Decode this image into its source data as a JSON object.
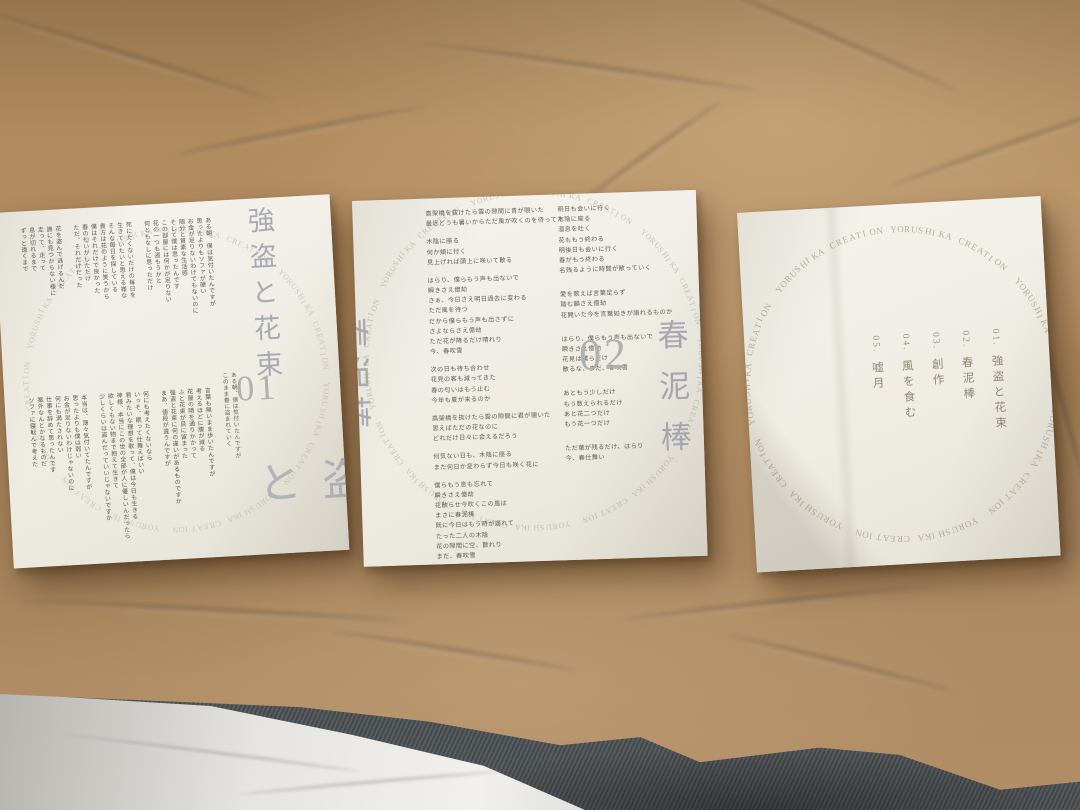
{
  "ring_text": "YORUSHIKA CREATION",
  "colors": {
    "kraft_paper": "#b28e66",
    "card_paper": "#f0ede5",
    "title_gray": "#a7abb3",
    "lyric_ink": "#5b584f",
    "ring_gray": "#b3ac97",
    "fabric_gray": "#4f5456",
    "tissue_white": "#eceae6"
  },
  "cards": {
    "left": {
      "title": "強盗と花束",
      "number": "01",
      "title_repeat": "強盗と",
      "number_caption": [
        [
          "ある朝、僕は気付いたんですが",
          "このまま春に盗まれていく"
        ]
      ],
      "lyrics_top": [
        [
          "ある朝、僕は気付いたんですが",
          "思ったよりもソファが硬い",
          "お金が足りないわけでもないのに",
          "随分と質素な生活感",
          "そして僕は思ったんです",
          "この部屋には何かが足りない",
          "花の一つも盗もうかと",
          "何ともなしに思っただけ"
        ],
        [
          "死にたくないだけの毎日を",
          "生きていたいと思える様な",
          "そんな毎日を探している",
          "貴方は花のように笑うから",
          "僕はそれだけで良かった",
          "春の匂いがしただけ",
          "ただ、それだけだった"
        ],
        [
          "花を盗んで逃げるんだ",
          "誰にも見つからない様に",
          "走って、走って",
          "息が切れるまで",
          "ずっと遠くまで"
        ]
      ],
      "lyrics_bottom": [
        [
          "言葉も無いまま歩いたんですが",
          "考えるほどに腹が減る",
          "花屋の隣を通りかかって",
          "ふと花束が目に留まった",
          "強盗と花束に何の違いがあるものですか",
          "まあ、値段が違うんですが"
        ],
        [
          "何にも考えたくないなら",
          "いっそ、眠って仕舞えばいい",
          "君みたいな理想を歌って、僕は今日も生きる",
          "神様、本当にこの世の全部が人に優しいんだったら",
          "欲しくもない物まで抱えて生きて",
          "少しくらいは盗んだっていいじゃないですか"
        ],
        [
          "本当は、薄々気付いてたんですが",
          "思ったよりも僕は弱い",
          "お金が足りないわけじゃないのに",
          "何にも満たされない",
          "仕事を辞めて思ったんです",
          "案外なんとかなるものだ",
          "ソファに寝転んで考えた"
        ]
      ]
    },
    "middle": {
      "title": "春泥棒",
      "side_title": "春泥棒",
      "number": "02",
      "lyrics_left": [
        [
          "高架橋を抜けたら雲の隙間に青が覗いた",
          "最近どうも暑いからただ風が吹くのを待ってた"
        ],
        [
          "木陰に座る",
          "何か頬に付く",
          "見上げれば頭上に咲いて散る"
        ],
        [
          "はらり、僕らもう声も出ないで",
          "瞬きさえ億劫",
          "さぁ、今日さえ明日過去に変わる",
          "ただ風を待つ",
          "だから僕らもう声も出さずに",
          "さよならさえ億劫",
          "ただ花が降るだけ晴れり",
          "今、春吹雪"
        ],
        [
          "次の日も待ち合わせ",
          "花見の客も減ってきた",
          "春の匂いはもう止む",
          "今年も夏が来るのか"
        ],
        [
          "高架橋を抜けたら雲の隙間に君が覗いた",
          "思えばただの花なのに",
          "どれだけ日々に会えるだろう"
        ],
        [
          "何気ない日も、木陰に座る",
          "また何日か変わらず今日も咲く花に"
        ],
        [
          "僕らもう息も忘れて",
          "瞬きさえ億劫",
          "花散らせ今吹くこの風は",
          "まさに春泥棒",
          "既に今日はもう時が遅れて",
          "たった二人の木陰",
          "花の隙間に空、散れり",
          "まだ、春吹雪"
        ]
      ],
      "lyrics_right": [
        [
          "明日も会いに行く",
          "木陰に座る",
          "溜息を吐く",
          "花ももう終わる",
          "明後日も会いに行く",
          "春がもう終わる",
          "名残るように時間が散っていく"
        ],
        [
          "愛を歌えば言葉足らず",
          "踏む韻さえ億劫",
          "花開いた今を言葉如きが語れるものか"
        ],
        [
          "はらり、僕らもう声も出ないで",
          "瞬きさえ億劫",
          "花見は僕らだけ",
          "散るな、まだ、春吹雪"
        ],
        [
          "あともう少しだけ",
          "もう数えられるだけ",
          "あと花二つだけ",
          "もう花一つだけ"
        ],
        [
          "ただ葉が残るだけ、はらり",
          "今、春仕舞い"
        ]
      ]
    },
    "right": {
      "tracks": [
        {
          "no": "01.",
          "title": "強盗と花束"
        },
        {
          "no": "02.",
          "title": "春泥棒"
        },
        {
          "no": "03.",
          "title": "創作"
        },
        {
          "no": "04.",
          "title": "風を食む"
        },
        {
          "no": "05.",
          "title": "嘘月"
        }
      ]
    }
  }
}
